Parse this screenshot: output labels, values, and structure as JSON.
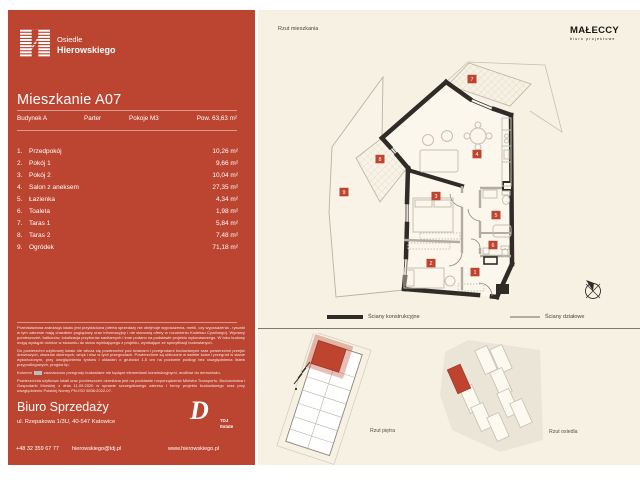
{
  "colors": {
    "brand_red": "#bc4531",
    "cream": "#f6f1e2",
    "wall_dark": "#2f2c28",
    "partition_gray": "#b2ada0",
    "marker_red": "#bf4430",
    "demolition_swatch": "#b7bec0"
  },
  "header": {
    "logo_line1": "Osiedle",
    "logo_line2": "Hierowskiego"
  },
  "apartment": {
    "title": "Mieszkanie A07",
    "building": "Budynek A",
    "floor": "Parter",
    "rooms_type": "Pokoje M3",
    "total_area": "Pow. 63,63 m²"
  },
  "rooms": [
    {
      "no": "1.",
      "name": "Przedpokój",
      "area": "10,26 m²"
    },
    {
      "no": "2.",
      "name": "Pokój 1",
      "area": "9,66 m²"
    },
    {
      "no": "3.",
      "name": "Pokój 2",
      "area": "10,04 m²"
    },
    {
      "no": "4.",
      "name": "Salon z aneksem",
      "area": "27,35 m²"
    },
    {
      "no": "5.",
      "name": "Łazienka",
      "area": "4,34 m²"
    },
    {
      "no": "6.",
      "name": "Toaleta",
      "area": "1,98 m²"
    },
    {
      "no": "7.",
      "name": "Taras 1",
      "area": "5,84 m²"
    },
    {
      "no": "8.",
      "name": "Taras 2",
      "area": "7,48 m²"
    },
    {
      "no": "9.",
      "name": "Ogródek",
      "area": "71,18 m²"
    }
  ],
  "disclaimer": {
    "p1": "Przedstawiona aranżacja lokalu jest przykładowa (oferta sprzedaży nie obejmuje wyposażenia, mebli, czy wyposażenia - rysunki w tym zakresie mają charakter poglądowy oraz informacyjny i nie stanowią oferty w rozumieniu Kodeksu Cywilnego). Wymiary pomieszczeń, balkonów, lokalizacja przyborów sanitarnych i inne podano na podstawie projektu wykonawczego. W toku budowy mogą wystąpić różnice w stosunku do stanu wynikającego z projektu, wynikające ze specyfikacji budowlanych.",
    "p2": "Do powierzchni użytkowej lokalu nie wlicza się powierzchni pod ścianami i przegrodami budowlanymi oraz powierzchni przejść drzwiowych, otworów okiennych, wnęk i nisz w tych przegrodach. Powierzchnie są obliczone w świetle ścian i przegród w stanie wykończonym, przy uwzględnieniu tynków i okładzin o grubości 1,5 cm na poziomie podłogi bez uwzględnienia listew przypodłogowych, progów itp.",
    "p3_before": "Kolorem",
    "p3_after": "zaznaczono przegrody budowlane nie będące elementami konstrukcyjnymi, możliwe do demontażu.",
    "p4": "Powierzchnia użytkowa lokali oraz pomieszczeń określana jest na podstawie rozporządzenia Ministra Transportu, Budownictwa i Gospodarki Morskiej z dnia 11.09.2020 w sprawie szczegółowego zakresu i formy projektu budowlanego oraz przy uwzględnieniu Polskiej Normy PN-ISO 9836:2022-07."
  },
  "sales_office": {
    "title": "Biuro Sprzedaży",
    "address": "ul. Rzepakowa 1/3U, 40-547 Katowice",
    "phone": "+48 32 359 67 77",
    "email": "hierowskiego@tdj.pl",
    "website": "www.hierowskiego.pl",
    "brand_letter": "D",
    "brand_line1": "TDJ",
    "brand_line2": "Estate"
  },
  "plan": {
    "label": "Rzut mieszkania",
    "architect": {
      "name": "MAŁECCY",
      "subtitle": "biuro projektowe"
    },
    "legend": [
      {
        "label": "Ściany konstrukcyjne"
      },
      {
        "label": "Ściany działowe"
      }
    ],
    "markers": [
      {
        "n": "1",
        "x": 475,
        "y": 272
      },
      {
        "n": "2",
        "x": 431,
        "y": 263
      },
      {
        "n": "3",
        "x": 436,
        "y": 196
      },
      {
        "n": "4",
        "x": 477,
        "y": 154
      },
      {
        "n": "5",
        "x": 496,
        "y": 215
      },
      {
        "n": "6",
        "x": 493,
        "y": 245
      },
      {
        "n": "7",
        "x": 472,
        "y": 79
      },
      {
        "n": "8",
        "x": 380,
        "y": 159
      },
      {
        "n": "9",
        "x": 344,
        "y": 192
      }
    ],
    "mini": {
      "floor_label": "Rzut piętra",
      "estate_label": "Rzut osiedla"
    }
  }
}
